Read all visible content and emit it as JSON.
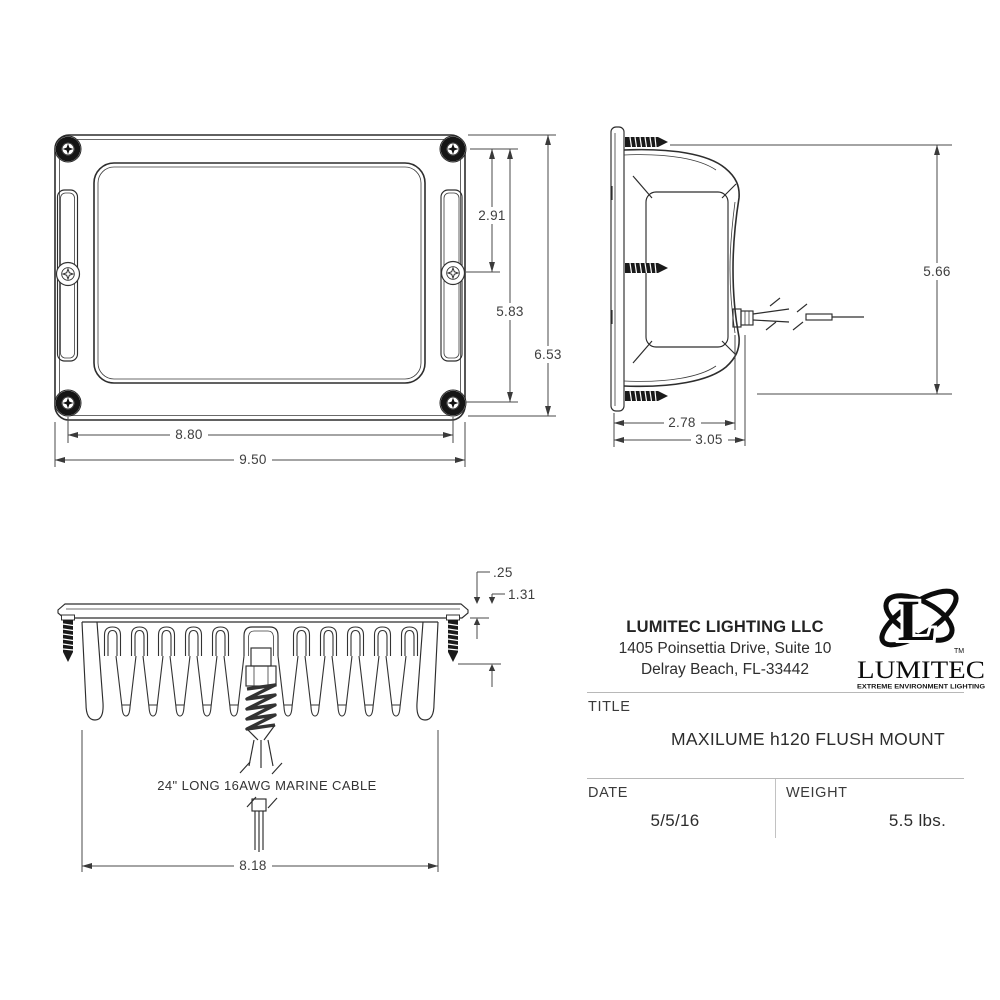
{
  "drawing": {
    "front": {
      "dims": {
        "v_inner": "2.91",
        "v_screws": "5.83",
        "v_overall": "6.53",
        "h_screws": "8.80",
        "h_overall": "9.50"
      }
    },
    "side": {
      "dims": {
        "v_overall": "5.66",
        "d_body": "2.78",
        "d_overall": "3.05"
      }
    },
    "bottom": {
      "dims": {
        "t_flange": ".25",
        "d_protrusion": "1.31",
        "w_body": "8.18"
      },
      "cable_label": "24\" LONG 16AWG MARINE CABLE"
    }
  },
  "title_block": {
    "company": "LUMITEC LIGHTING LLC",
    "address_line1": "1405 Poinsettia Drive, Suite 10",
    "address_line2": "Delray Beach, FL-33442",
    "logo": {
      "letter": "L",
      "tm": "TM",
      "wordmark": "LUMITEC",
      "tagline": "EXTREME ENVIRONMENT LIGHTING"
    },
    "title_label": "TITLE",
    "title_value": "MAXILUME h120 FLUSH MOUNT",
    "date_label": "DATE",
    "date_value": "5/5/16",
    "weight_label": "WEIGHT",
    "weight_value": "5.5 lbs."
  }
}
